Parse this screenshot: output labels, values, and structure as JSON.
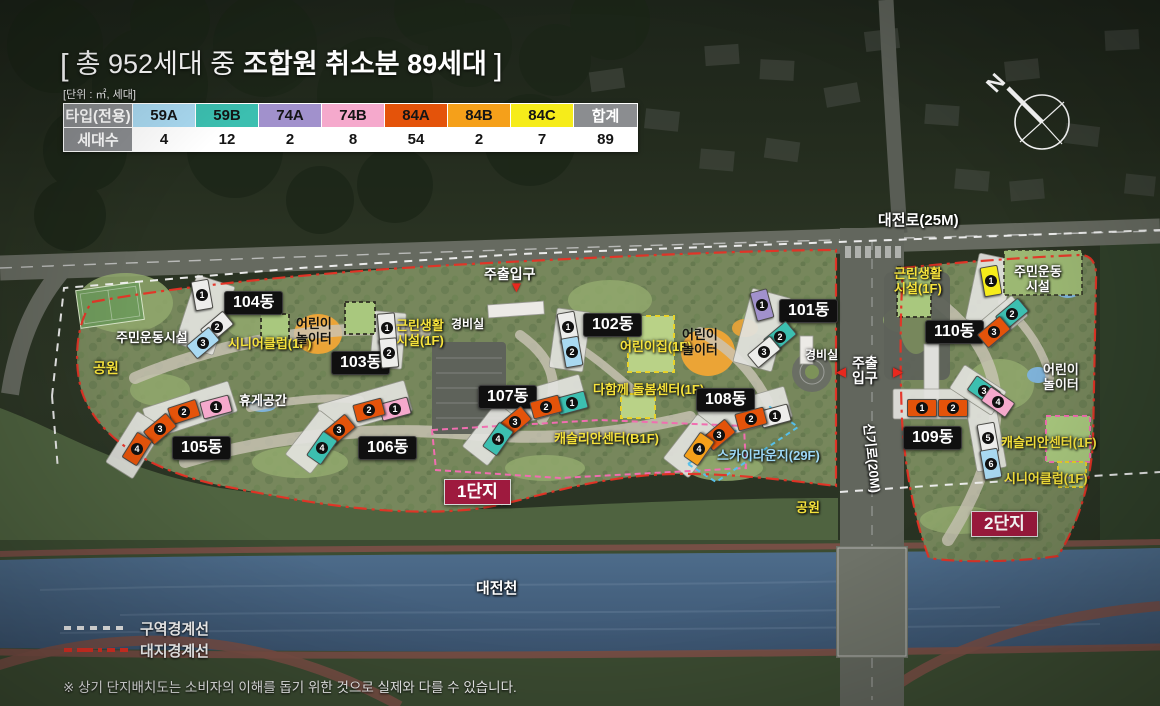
{
  "header": {
    "title": {
      "open": "[",
      "normal": "총 952세대 중",
      "bold": "조합원 취소분 89세대",
      "close": "]"
    },
    "unit_note": "[단위 : ㎡, 세대]"
  },
  "table": {
    "type_header": "타입(전용)",
    "count_header": "세대수",
    "total_header": "합계",
    "total_count": "89",
    "header_bg": "#8b8d90",
    "types": [
      {
        "label": "59A",
        "count": "4",
        "color": "#a9d9f1"
      },
      {
        "label": "59B",
        "count": "12",
        "color": "#3cbfb0"
      },
      {
        "label": "74A",
        "count": "2",
        "color": "#a191cc"
      },
      {
        "label": "74B",
        "count": "8",
        "color": "#f5a9cc"
      },
      {
        "label": "84A",
        "count": "54",
        "color": "#e4530a"
      },
      {
        "label": "84B",
        "count": "2",
        "color": "#f5a01a"
      },
      {
        "label": "84C",
        "count": "7",
        "color": "#f6ec1a"
      }
    ]
  },
  "map": {
    "compass_n": "N",
    "roads": {
      "daejeonro": "대전로(25M)",
      "singiro": "신기로(20M)"
    },
    "river": "대전천",
    "complex1_label": "1단지",
    "complex2_label": "2단지",
    "entrance_main": "주출입구",
    "entrance_line1": "주출",
    "entrance_line2": "입구",
    "guard_office": "경비실",
    "labels": {
      "sports_full": "주민운동시설",
      "sports_l1": "주민운동",
      "sports_l2": "시설",
      "park": "공원",
      "rest_area": "휴게공간",
      "kids_l1": "어린이",
      "kids_l2": "놀이터",
      "daycare": "어린이집(1F)",
      "senior_club": "시니어클럽(1F)",
      "neigh_l1": "근린생활",
      "neigh_l2": "시설(1F)",
      "care_center": "다함께 돌봄센터(1F)",
      "caslian_b1": "캐슬리안센터(B1F)",
      "caslian_1f": "캐슬리안센터(1F)",
      "sky_lounge": "스카이라운지(29F)"
    },
    "buildings": [
      {
        "name": "101동",
        "units": [
          {
            "no": "1",
            "type": "74A"
          },
          {
            "no": "2",
            "type": "59B"
          },
          {
            "no": "3",
            "type": "-"
          }
        ]
      },
      {
        "name": "102동",
        "units": [
          {
            "no": "1",
            "type": "-"
          },
          {
            "no": "2",
            "type": "59A"
          }
        ]
      },
      {
        "name": "103동",
        "units": [
          {
            "no": "1",
            "type": "-"
          },
          {
            "no": "2",
            "type": "-"
          }
        ]
      },
      {
        "name": "104동",
        "units": [
          {
            "no": "1",
            "type": "-"
          },
          {
            "no": "2",
            "type": "-"
          },
          {
            "no": "3",
            "type": "59A"
          }
        ]
      },
      {
        "name": "105동",
        "units": [
          {
            "no": "1",
            "type": "74B"
          },
          {
            "no": "2",
            "type": "84A"
          },
          {
            "no": "3",
            "type": "84A"
          },
          {
            "no": "4",
            "type": "84A"
          }
        ]
      },
      {
        "name": "106동",
        "units": [
          {
            "no": "1",
            "type": "74B"
          },
          {
            "no": "2",
            "type": "84A"
          },
          {
            "no": "3",
            "type": "84A"
          },
          {
            "no": "4",
            "type": "59B"
          }
        ]
      },
      {
        "name": "107동",
        "units": [
          {
            "no": "1",
            "type": "59B"
          },
          {
            "no": "2",
            "type": "84A"
          },
          {
            "no": "3",
            "type": "84A"
          },
          {
            "no": "4",
            "type": "59B"
          }
        ]
      },
      {
        "name": "108동",
        "units": [
          {
            "no": "1",
            "type": "-"
          },
          {
            "no": "2",
            "type": "84A"
          },
          {
            "no": "3",
            "type": "84A"
          },
          {
            "no": "4",
            "type": "84B"
          }
        ]
      },
      {
        "name": "109동",
        "units": [
          {
            "no": "1",
            "type": "84A"
          },
          {
            "no": "2",
            "type": "84A"
          },
          {
            "no": "3",
            "type": "59B"
          },
          {
            "no": "4",
            "type": "74B"
          },
          {
            "no": "5",
            "type": "-"
          },
          {
            "no": "6",
            "type": "59A"
          }
        ]
      },
      {
        "name": "110동",
        "units": [
          {
            "no": "1",
            "type": "84C"
          },
          {
            "no": "2",
            "type": "59B"
          },
          {
            "no": "3",
            "type": "84A"
          }
        ]
      }
    ]
  },
  "legend": {
    "zone_boundary": "구역경계선",
    "site_boundary": "대지경계선"
  },
  "footer_note": "※ 상기 단지배치도는 소비자의 이해를 돕기 위한 것으로 실제와 다를 수 있습니다.",
  "colors": {
    "danji_badge": "#9e1a3e",
    "zone_line": "#f2f2f2",
    "site_line": "#e63225",
    "sky_dash": "#56c0ea",
    "pink_dash": "#f06eb0",
    "yellow_dash": "#e8d22a"
  }
}
